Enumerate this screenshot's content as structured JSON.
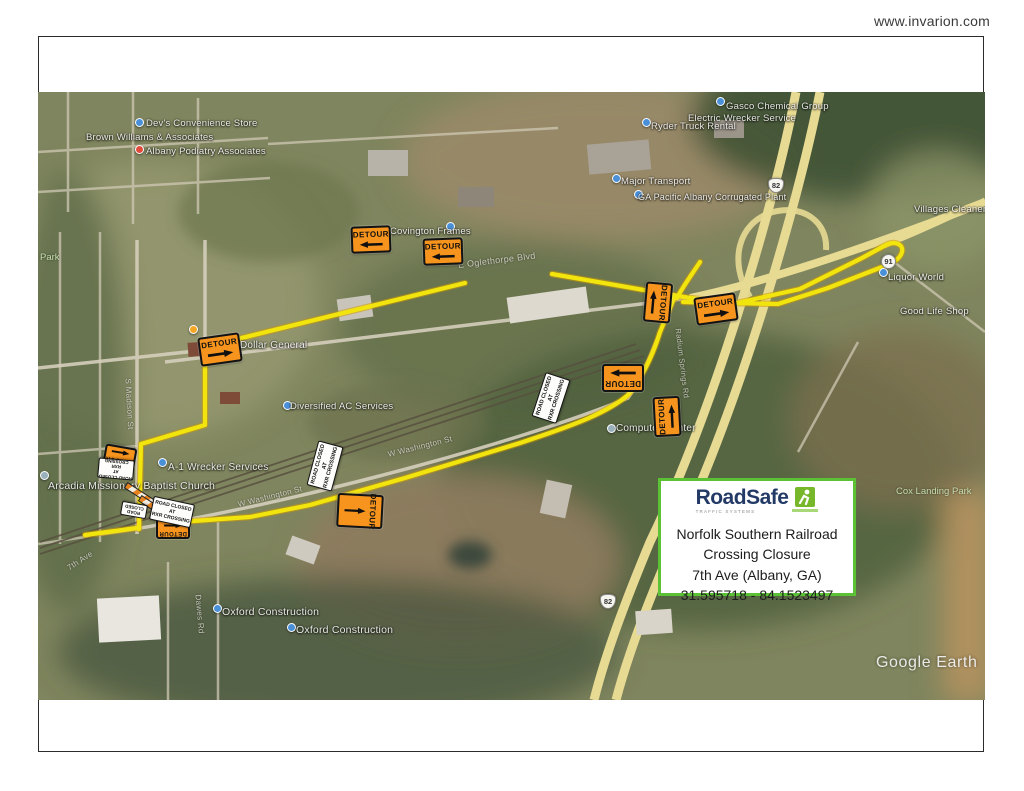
{
  "header": {
    "website": "www.invarion.com"
  },
  "info_box": {
    "brand": "RoadSafe",
    "brand_sub": "TRAFFIC SYSTEMS",
    "line1": "Norfolk Southern Railroad",
    "line2": "Crossing Closure",
    "line3": "7th Ave (Albany, GA)",
    "line4": "31.595718 - 84.1523497",
    "border_color": "#5bc236"
  },
  "signs": {
    "detour": "DETOUR",
    "road_closed": [
      "ROAD CLOSED",
      "AT",
      "RXR CROSSING"
    ],
    "road_closed_short": [
      "ROAD",
      "CLOSED"
    ],
    "sign_orange": "#f7941d",
    "route_yellow": "#f2e50e"
  },
  "shields": {
    "us82": "82",
    "ga91": "91"
  },
  "map": {
    "watermark": "Google Earth",
    "pois": [
      {
        "text": "Dev's Convenience Store"
      },
      {
        "text": "Brown Williams & Associates"
      },
      {
        "text": "Albany Podiatry Associates"
      },
      {
        "text": "Covington Frames"
      },
      {
        "text": "Gasco Chemical Group"
      },
      {
        "text": "Electric Wrecker Service"
      },
      {
        "text": "Ryder Truck Rental"
      },
      {
        "text": "Major Transport"
      },
      {
        "text": "GA Pacific Albany Corrugated Plant"
      },
      {
        "text": "Dollar General"
      },
      {
        "text": "Diversified AC Services"
      },
      {
        "text": "Computer Center"
      },
      {
        "text": "A-1 Wrecker Services"
      },
      {
        "text": "Arcadia Missionary Baptist Church"
      },
      {
        "text": "Oxford Construction"
      },
      {
        "text": "Oxford Construction"
      },
      {
        "text": "Villages Cleaners"
      },
      {
        "text": "Liquor World"
      },
      {
        "text": "Good Life Shop"
      }
    ],
    "streets": [
      {
        "text": "E Oglethorpe Blvd"
      },
      {
        "text": "W Washington St"
      },
      {
        "text": "W Washington St"
      },
      {
        "text": "7th Ave"
      },
      {
        "text": "Dawes Rd"
      },
      {
        "text": "S Madison St"
      },
      {
        "text": "Radium Springs Rd"
      }
    ],
    "parks": [
      {
        "text": "Park"
      },
      {
        "text": "Cox Landing Park"
      }
    ]
  }
}
